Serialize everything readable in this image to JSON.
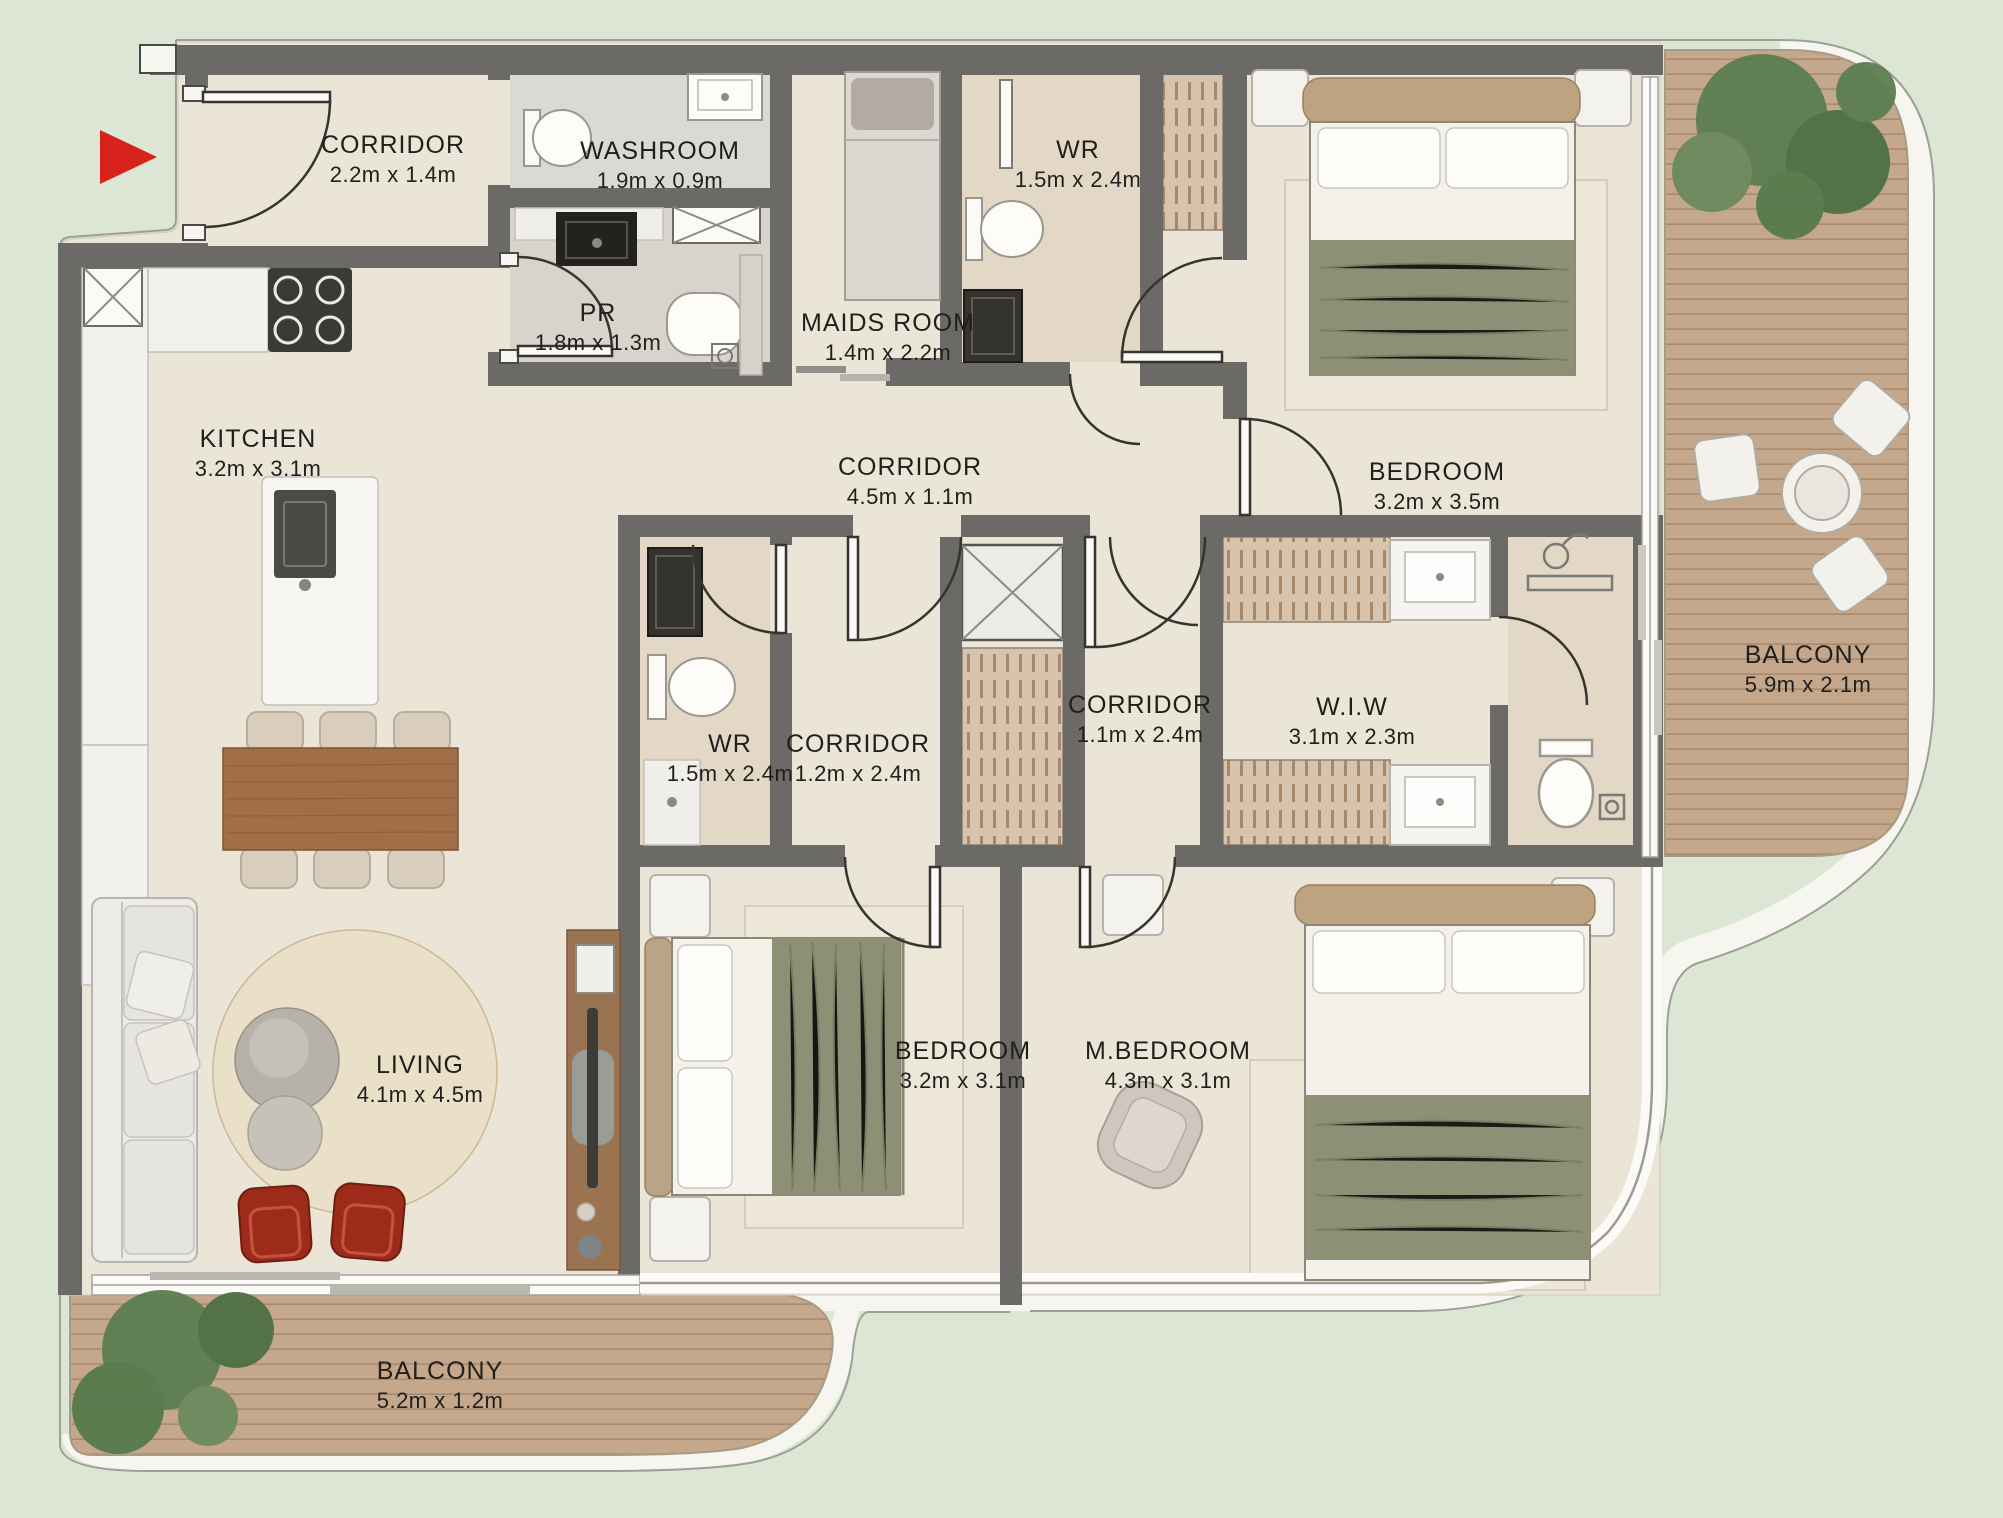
{
  "palette": {
    "background": "#dde6d4",
    "floor": "#ebe5d8",
    "wall": "#6b6a66",
    "deck_wood": "#c5a88c",
    "bath_tile": "#e2d5c3",
    "olive_bedding": "#8e9076",
    "accent_red": "#d7231b",
    "label_text": "#211f1b"
  },
  "entry": {
    "marker_icon": "entry-arrow"
  },
  "labels": {
    "entry_corridor": {
      "name": "CORRIDOR",
      "dims": "2.2m x 1.4m"
    },
    "washroom": {
      "name": "WASHROOM",
      "dims": "1.9m x 0.9m"
    },
    "powder_room": {
      "name": "PR",
      "dims": "1.8m x 1.3m"
    },
    "maids_room": {
      "name": "MAIDS ROOM",
      "dims": "1.4m x 2.2m"
    },
    "wr_top": {
      "name": "WR",
      "dims": "1.5m x 2.4m"
    },
    "kitchen": {
      "name": "KITCHEN",
      "dims": "3.2m x 3.1m"
    },
    "corridor_main": {
      "name": "CORRIDOR",
      "dims": "4.5m x 1.1m"
    },
    "bedroom_top": {
      "name": "BEDROOM",
      "dims": "3.2m x 3.5m"
    },
    "balcony_right": {
      "name": "BALCONY",
      "dims": "5.9m x 2.1m"
    },
    "wr_mid": {
      "name": "WR",
      "dims": "1.5m x 2.4m"
    },
    "corridor_12": {
      "name": "CORRIDOR",
      "dims": "1.2m x 2.4m"
    },
    "corridor_11": {
      "name": "CORRIDOR",
      "dims": "1.1m x 2.4m"
    },
    "wiw": {
      "name": "W.I.W",
      "dims": "3.1m x 2.3m"
    },
    "living": {
      "name": "LIVING",
      "dims": "4.1m x 4.5m"
    },
    "bedroom_bottom": {
      "name": "BEDROOM",
      "dims": "3.2m x 3.1m"
    },
    "master_bedroom": {
      "name": "M.BEDROOM",
      "dims": "4.3m x 3.1m"
    },
    "balcony_bottom": {
      "name": "BALCONY",
      "dims": "5.2m x 1.2m"
    }
  }
}
